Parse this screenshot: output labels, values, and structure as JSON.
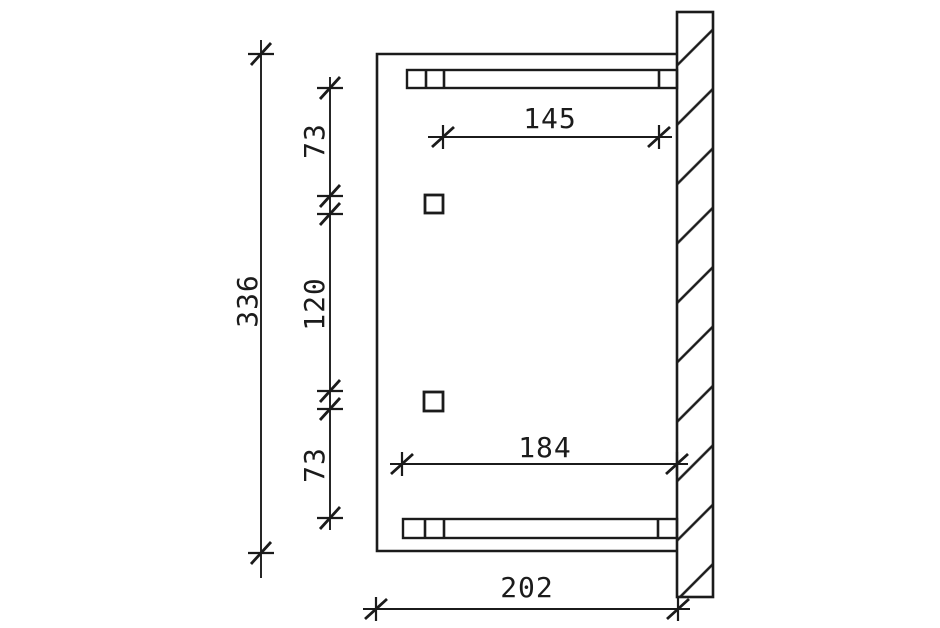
{
  "drawing": {
    "kind": "technical-dimension-drawing",
    "colors": {
      "line": "#1b1b1b",
      "background": "#ffffff"
    },
    "dimension_labels": {
      "depth_total": "336",
      "depth_top_segment": "73",
      "depth_middle_segment": "120",
      "depth_bottom_segment": "73",
      "width_post_to_wall": "145",
      "width_beam_to_wall": "184",
      "width_total": "202"
    }
  }
}
